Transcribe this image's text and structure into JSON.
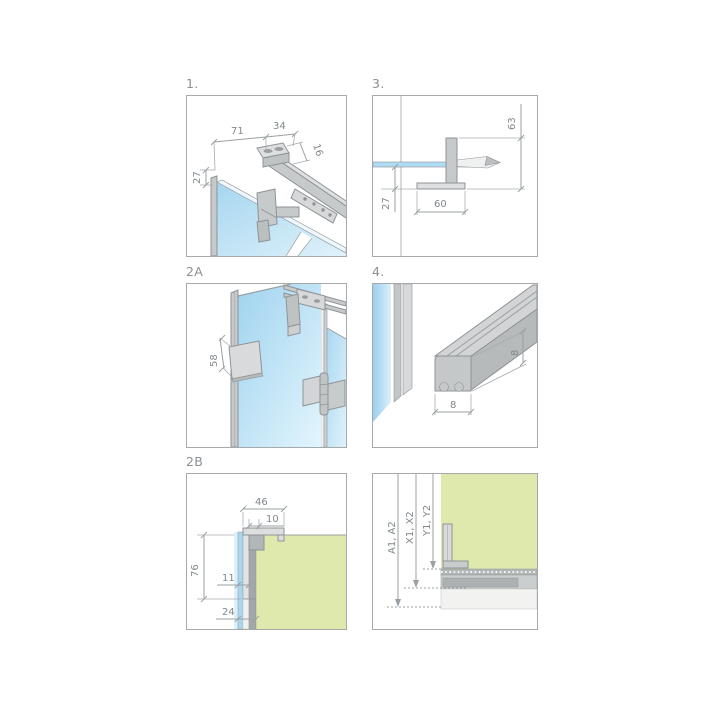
{
  "sheet": {
    "description": "Shower enclosure installation detail sheet with six technical drawings",
    "background": "#ffffff"
  },
  "colors": {
    "panel_border": "#a6aaad",
    "label_text": "#8a9094",
    "dimension_line": "#9aa0a3",
    "dimension_text": "#82888c",
    "hardware_mid": "#c7cacb",
    "hardware_light": "#dddfe0",
    "hardware_dark": "#b4b7b8",
    "outline": "#8f9396",
    "glass_blue": "#a6d6f0",
    "glass_blue_light": "#e0f3fc",
    "wall_green": "#dfe9ad",
    "floor_light": "#f2f2f0"
  },
  "panels": [
    {
      "id": "1",
      "label": "1.",
      "dims": {
        "width_71": "71",
        "width_34": "34",
        "height_16": "16",
        "height_27": "27"
      }
    },
    {
      "id": "3",
      "label": "3.",
      "dims": {
        "height_63": "63",
        "height_27": "27",
        "width_60": "60"
      }
    },
    {
      "id": "2A",
      "label": "2A",
      "dims": {
        "height_58": "58"
      }
    },
    {
      "id": "4",
      "label": "4.",
      "dims": {
        "width_8": "8",
        "height_8": "8"
      }
    },
    {
      "id": "2B",
      "label": "2B",
      "dims": {
        "width_46": "46",
        "width_10": "10",
        "height_76": "76",
        "width_11": "11",
        "width_24": "24"
      }
    },
    {
      "id": "levels",
      "label": "",
      "levels": {
        "a": "A1, A2",
        "x": "X1, X2",
        "y": "Y1, Y2"
      }
    }
  ]
}
